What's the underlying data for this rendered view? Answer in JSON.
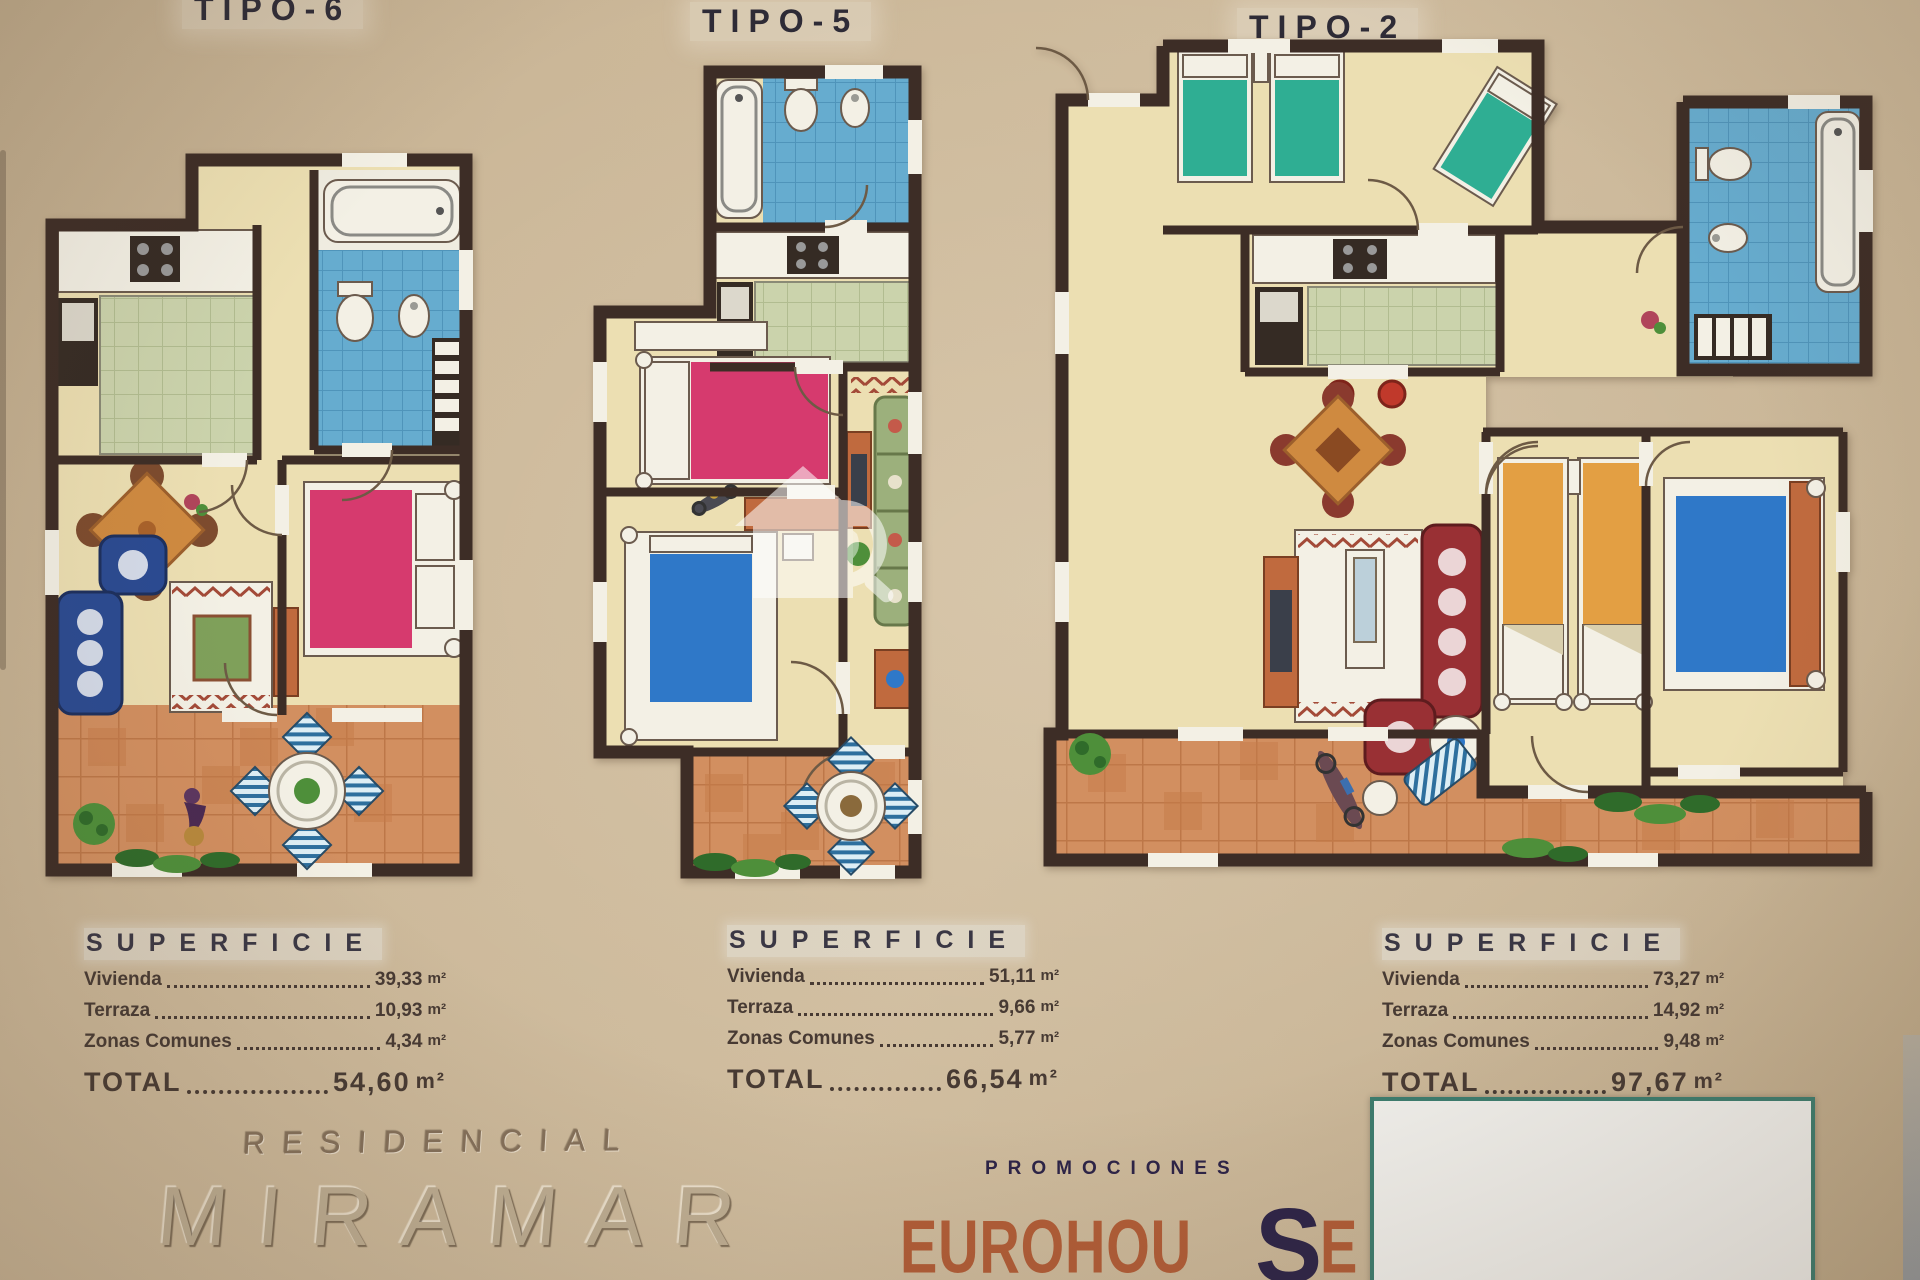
{
  "colors": {
    "wall": "#3d2d26",
    "floor": "#ecdfb2",
    "terr": "#d28f60",
    "terrLine": "#bd7748",
    "terrDark": "#c67c49",
    "bath": "#66accf",
    "bathLine": "#4f94ba",
    "kitch": "#cbd3ac",
    "kitchLine": "#b1bc90",
    "white": "#f3f0e5",
    "dark": "#352b24",
    "pink": "#d63a6e",
    "blue": "#2f78c8",
    "teal": "#2fae93",
    "orangeBed": "#e39f43",
    "sofaBlue": "#2a4a92",
    "sofaRed": "#993034",
    "sofaGreen": "#9cb07c",
    "tableOrange": "#cf8a40",
    "chairBrown": "#7d4b2e",
    "plant": "#4e8f3a",
    "plantDark": "#2f6b2a",
    "rugBorder": "#a34a38",
    "stripeBlue": "#2d6f9e",
    "stripeBg": "#ddeef5",
    "text": "#2e2b36",
    "tableText": "#473a33",
    "brandOrange": "#b05c36",
    "brandNavy": "#2c2347",
    "boxBorder": "#3c7c6e",
    "boxFill": "#efeeea"
  },
  "plans": [
    {
      "id": "tipo-6",
      "title": "TIPO-6",
      "superficie": {
        "heading": "SUPERFICIE",
        "rows": [
          {
            "label": "Vivienda",
            "value": "39,33",
            "unit": "m²"
          },
          {
            "label": "Terraza",
            "value": "10,93",
            "unit": "m²"
          },
          {
            "label": "Zonas Comunes",
            "value": "4,34",
            "unit": "m²"
          }
        ],
        "total_label": "TOTAL",
        "total_value": "54,60",
        "total_unit": "m²"
      }
    },
    {
      "id": "tipo-5",
      "title": "TIPO-5",
      "superficie": {
        "heading": "SUPERFICIE",
        "rows": [
          {
            "label": "Vivienda",
            "value": "51,11",
            "unit": "m²"
          },
          {
            "label": "Terraza",
            "value": "9,66",
            "unit": "m²"
          },
          {
            "label": "Zonas Comunes",
            "value": "5,77",
            "unit": "m²"
          }
        ],
        "total_label": "TOTAL",
        "total_value": "66,54",
        "total_unit": "m²"
      }
    },
    {
      "id": "tipo-2",
      "title": "TIPO-2",
      "superficie": {
        "heading": "SUPERFICIE",
        "rows": [
          {
            "label": "Vivienda",
            "value": "73,27",
            "unit": "m²"
          },
          {
            "label": "Terraza",
            "value": "14,92",
            "unit": "m²"
          },
          {
            "label": "Zonas Comunes",
            "value": "9,48",
            "unit": "m²"
          }
        ],
        "total_label": "TOTAL",
        "total_value": "97,67",
        "total_unit": "m²"
      }
    }
  ],
  "branding": {
    "residencial": "RESIDENCIAL",
    "name": "MIRAMAR",
    "promociones": "PROMOCIONES",
    "brand_pre_s": "EUROHOU",
    "brand_s": "S",
    "brand_post_s": "E 2010.",
    "brand_suffix": "S.L."
  }
}
